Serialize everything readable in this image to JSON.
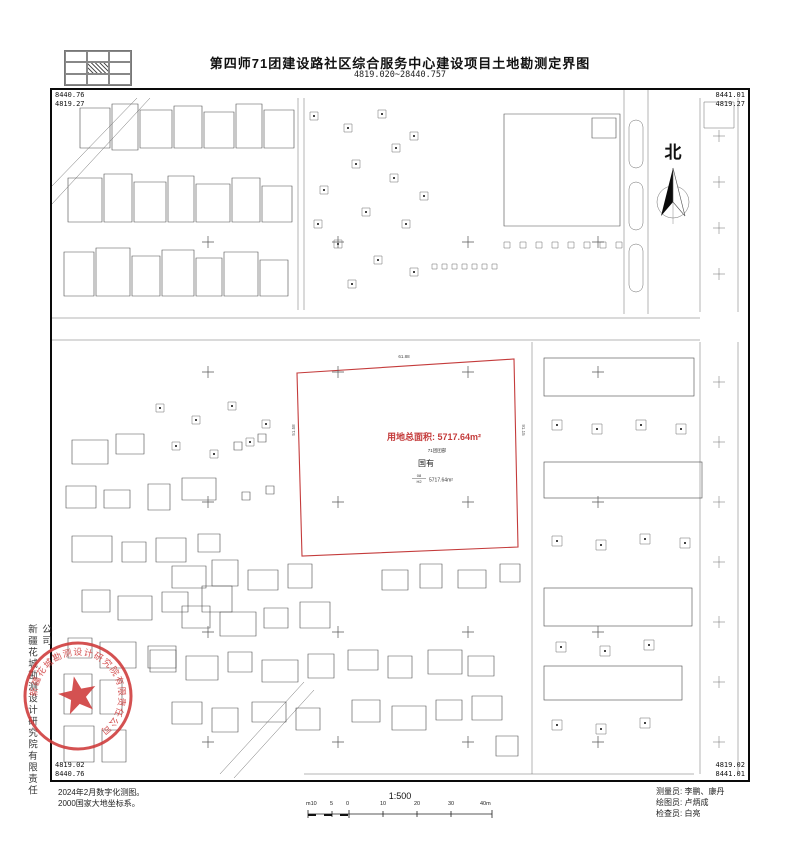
{
  "header": {
    "title": "第四师71团建设路社区综合服务中心建设项目土地勘测定界图",
    "subtitle": "4819.020~28440.757"
  },
  "frame": {
    "top_left": [
      "8440.76",
      "4819.27"
    ],
    "top_right": [
      "8441.01",
      "4819.27"
    ],
    "bottom_left": [
      "4819.02",
      "8440.76"
    ],
    "bottom_right": [
      "4819.02",
      "8441.01"
    ]
  },
  "north": {
    "label": "北"
  },
  "parcel": {
    "area_label": "用地总面积: 5717.64m²",
    "locality": "71团团部",
    "ownership": "国有",
    "class_frac_top": "08",
    "class_frac_bottom": "H2",
    "class_area": "5717.64m²",
    "dim_top": "61.88",
    "dim_left": "51.58",
    "dim_right": "91.15",
    "boundary_color": "#c43b3b"
  },
  "footer": {
    "notes": [
      "2024年2月数字化测图。",
      "2000国家大地坐标系。"
    ],
    "scale": {
      "ratio": "1:500",
      "ticks": [
        "m10",
        "5",
        "0",
        "10",
        "20",
        "30",
        "40m"
      ]
    },
    "credits": [
      {
        "label": "测量员:",
        "value": "李鹏、康丹"
      },
      {
        "label": "绘图员:",
        "value": "卢炳成"
      },
      {
        "label": "检查员:",
        "value": "白亮"
      }
    ]
  },
  "margin": {
    "company": "新疆花城勘测设计研究院有限责任公司"
  },
  "seal": {
    "ring_text": "新疆花城勘测设计研究院有限责任公司",
    "color": "#cf3a3a"
  }
}
